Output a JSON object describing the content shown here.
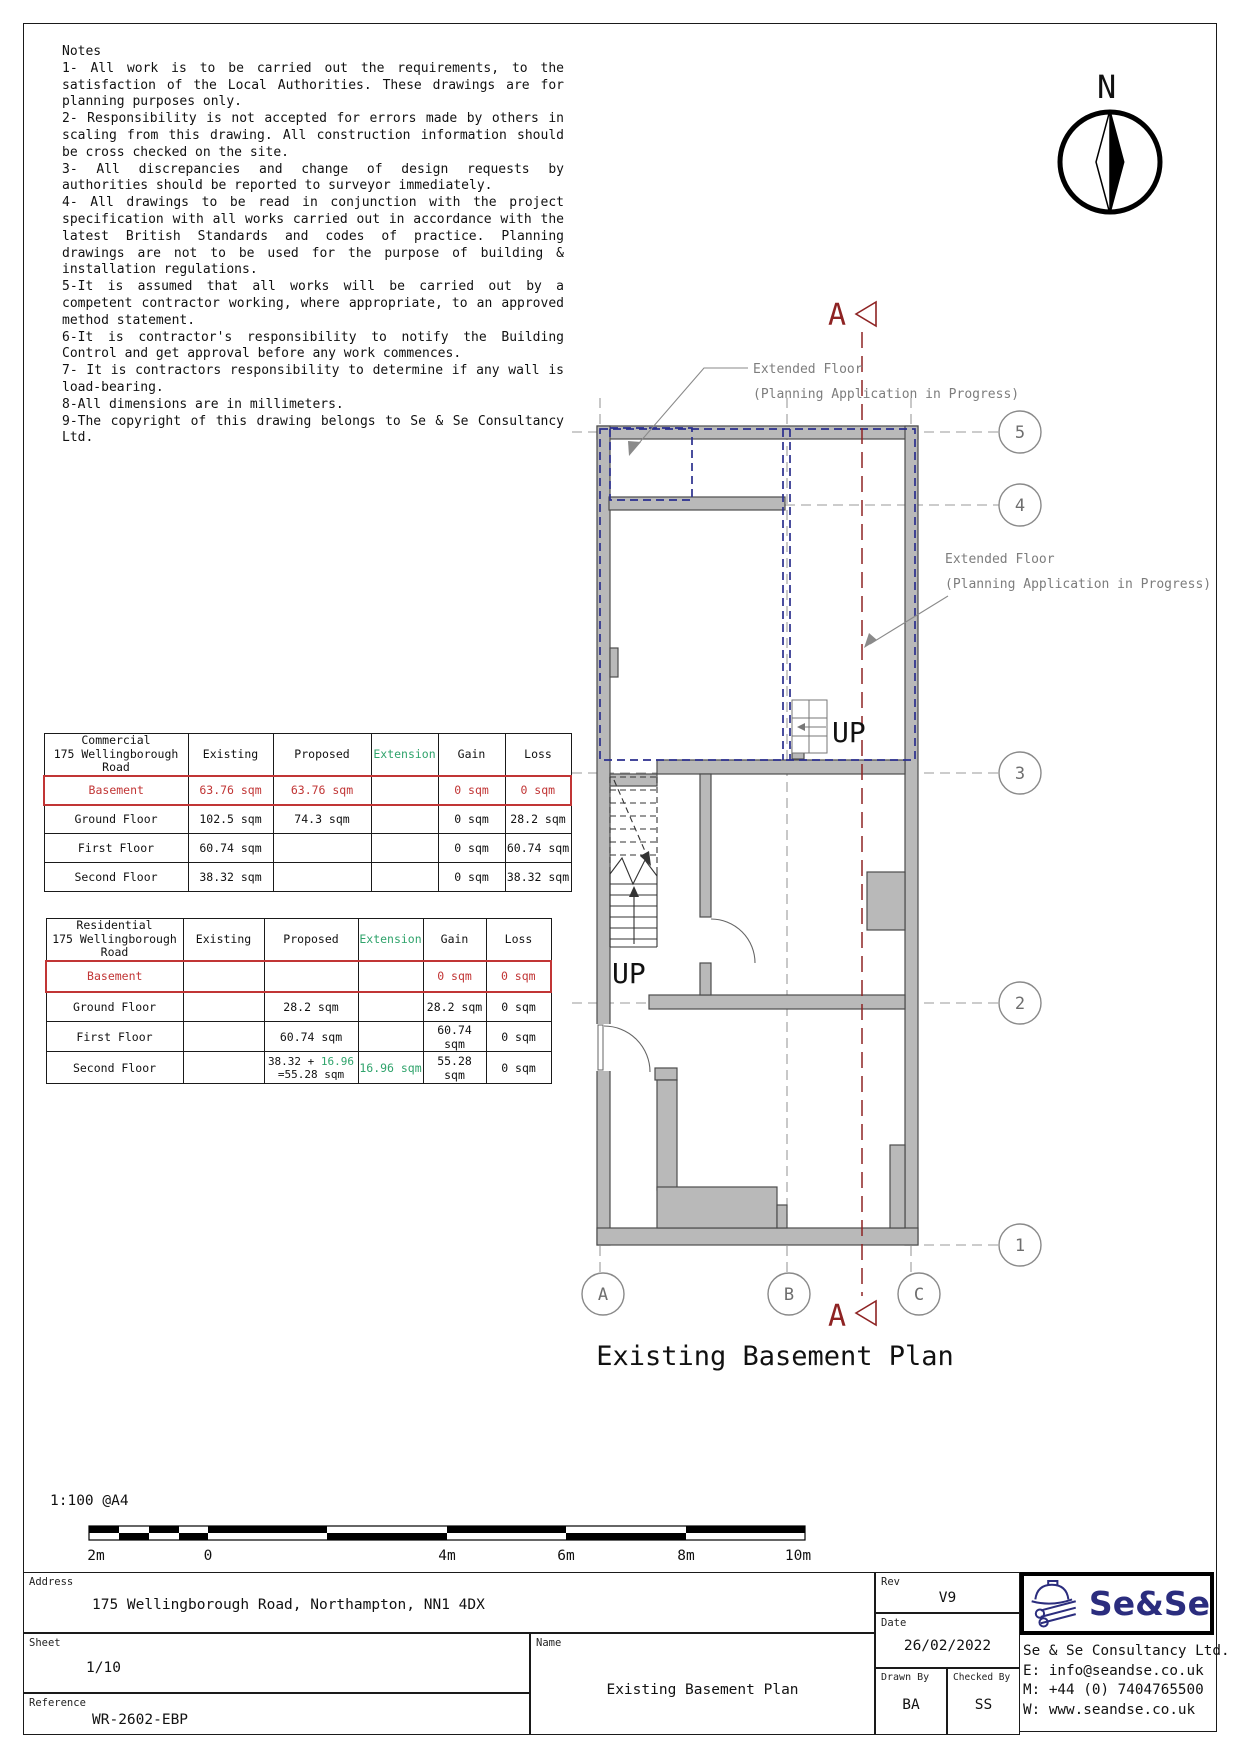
{
  "colors": {
    "table_red": "#c13535",
    "section_red": "#8e2323",
    "extension_green": "#2fa36b",
    "overlay_navy": "#2b2f8e",
    "wall_gray": "#b9b9b9",
    "grid_gray": "#8a8a8a",
    "label_gray": "#7d7d7d",
    "logo_navy": "#2b2d7e"
  },
  "notes": {
    "title": "Notes",
    "items": [
      "1- All work is to be carried out the requirements, to the satisfaction of the Local Authorities. These drawings are for planning purposes only.",
      "2- Responsibility is not accepted for errors made by others in scaling from this drawing. All construction information should be cross checked on the site.",
      "3- All discrepancies and change of design requests by authorities should be reported to surveyor immediately.",
      "4- All drawings to be read in conjunction with the project specification with all works carried out in accordance with the latest British Standards and codes of practice. Planning drawings are not to be used for the purpose of building & installation regulations.",
      "5-It is assumed that all works will be carried out by a competent contractor working, where appropriate, to an approved method statement.",
      "6-It is contractor's responsibility to notify the Building Control and get approval before any work commences.",
      "7- It is contractors responsibility to determine if any wall is load-bearing.",
      "8-All dimensions are in millimeters.",
      "9-The copyright of this drawing belongs to Se & Se Consultancy Ltd."
    ]
  },
  "north": {
    "label": "N"
  },
  "plan": {
    "title": "Existing Basement Plan",
    "up_label": "UP",
    "extended_floor_line1": "Extended Floor",
    "extended_floor_line2": "(Planning Application in Progress)",
    "section_label": "A",
    "grid_right": [
      "5",
      "4",
      "3",
      "2",
      "1"
    ],
    "grid_bottom": [
      "A",
      "B",
      "C"
    ]
  },
  "tables": {
    "commercial": {
      "title_line1": "Commercial",
      "title_line2": "175 Wellingborough Road",
      "headers": {
        "existing": "Existing",
        "proposed": "Proposed",
        "extension": "Extension",
        "gain": "Gain",
        "loss": "Loss"
      },
      "rows": [
        {
          "name": "Basement",
          "existing": "63.76 sqm",
          "proposed": "63.76 sqm",
          "extension": "",
          "gain": "0 sqm",
          "loss": "0 sqm"
        },
        {
          "name": "Ground Floor",
          "existing": "102.5 sqm",
          "proposed": "74.3 sqm",
          "extension": "",
          "gain": "0 sqm",
          "loss": "28.2 sqm"
        },
        {
          "name": "First Floor",
          "existing": "60.74 sqm",
          "proposed": "",
          "extension": "",
          "gain": "0 sqm",
          "loss": "60.74 sqm"
        },
        {
          "name": "Second Floor",
          "existing": "38.32 sqm",
          "proposed": "",
          "extension": "",
          "gain": "0 sqm",
          "loss": "38.32 sqm"
        }
      ]
    },
    "residential": {
      "title_line1": "Residential",
      "title_line2": "175 Wellingborough Road",
      "headers": {
        "existing": "Existing",
        "proposed": "Proposed",
        "extension": "Extension",
        "gain": "Gain",
        "loss": "Loss"
      },
      "rows": [
        {
          "name": "Basement",
          "existing": "",
          "proposed": "",
          "extension": "",
          "gain": "0 sqm",
          "loss": "0 sqm"
        },
        {
          "name": "Ground Floor",
          "existing": "",
          "proposed": "28.2 sqm",
          "extension": "",
          "gain": "28.2 sqm",
          "loss": "0 sqm"
        },
        {
          "name": "First Floor",
          "existing": "",
          "proposed": "60.74 sqm",
          "extension": "",
          "gain": "60.74 sqm",
          "loss": "0 sqm"
        },
        {
          "name": "Second Floor",
          "existing": "",
          "proposed_part1": "38.32 + ",
          "proposed_green": "16.96",
          "proposed_line2": "=55.28 sqm",
          "extension": "16.96 sqm",
          "gain": "55.28 sqm",
          "loss": "0 sqm"
        }
      ]
    }
  },
  "scalebar": {
    "label": "1:100  @A4",
    "ticks": [
      "2m",
      "0",
      "4m",
      "6m",
      "8m",
      "10m"
    ]
  },
  "titleblock": {
    "address_label": "Address",
    "address": "175 Wellingborough Road, Northampton, NN1 4DX",
    "sheet_label": "Sheet",
    "sheet": "1/10",
    "reference_label": "Reference",
    "reference": "WR-2602-EBP",
    "name_label": "Name",
    "name": "Existing Basement Plan",
    "rev_label": "Rev",
    "rev": "V9",
    "date_label": "Date",
    "date": "26/02/2022",
    "drawn_by_label": "Drawn By",
    "drawn_by": "BA",
    "checked_by_label": "Checked By",
    "checked_by": "SS",
    "logo_text": "Se&Se",
    "company": "Se & Se Consultancy Ltd.",
    "email": "E: info@seandse.co.uk",
    "mobile": "M: +44 (0) 7404765500",
    "website": "W: www.seandse.co.uk"
  }
}
